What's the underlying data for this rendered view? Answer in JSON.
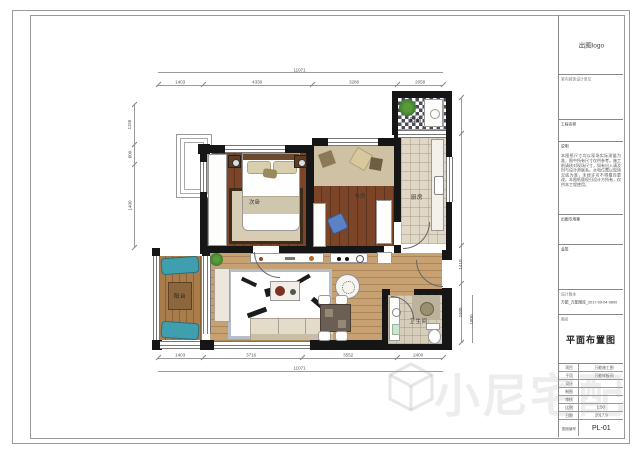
{
  "rooms": {
    "bedroom": "次卧",
    "study": "书房",
    "kitchen": "厨房",
    "balcony_left": "阳台",
    "balcony_top": "阳台",
    "bathroom": "卫生间"
  },
  "dims": {
    "top_total": "11071",
    "top": [
      "1403",
      "4330",
      "3280",
      "2058"
    ],
    "bottom": [
      "1403",
      "3716",
      "3552",
      "2400"
    ],
    "bottom_total": "11071",
    "left": [
      "1156",
      "800",
      "1400"
    ],
    "right": [
      "1410",
      "2400",
      "1800"
    ]
  },
  "titleblock": {
    "logo": "出图logo",
    "company": "室内装饰设计单位",
    "project_label": "工程名称",
    "notes_label": "说明",
    "notes_text": "本图纸尺寸均以现场实际测量为准，图中所有尺寸仅供参考。施工前请核对现场尺寸，如有出入请及时与设计师联系。水电位置以现场交底为准，未经许可不得擅自更改。本图纸版权归设计方所有，仅供本工程使用。",
    "stamp_label": "出图专用章",
    "sign_label": "会签",
    "version_label": "设计版本",
    "version_value": "万能_万能图库_2017-09-04-0800",
    "drawing_name_label": "图名",
    "drawing_name": "平面布置图",
    "rows": [
      {
        "label": "项目",
        "value": "万能施工图"
      },
      {
        "label": "子项",
        "value": "万能样板间"
      },
      {
        "label": "设计",
        "value": ""
      },
      {
        "label": "制图",
        "value": ""
      },
      {
        "label": "审核",
        "value": ""
      },
      {
        "label": "比例",
        "value": "1:50"
      },
      {
        "label": "日期",
        "value": "2017.9"
      },
      {
        "label": "图纸编号",
        "value": "PL-01"
      }
    ]
  },
  "watermark": {
    "text": "小尼宅配"
  },
  "colors": {
    "wall": "#161616",
    "wood_dark": "#7c4527",
    "wood_light": "#c8a173",
    "balcony_wood": "#a97c4c",
    "tile": "#e0d7c7",
    "accent_chair": "#5b82c4",
    "lounger": "#3f9fae"
  }
}
